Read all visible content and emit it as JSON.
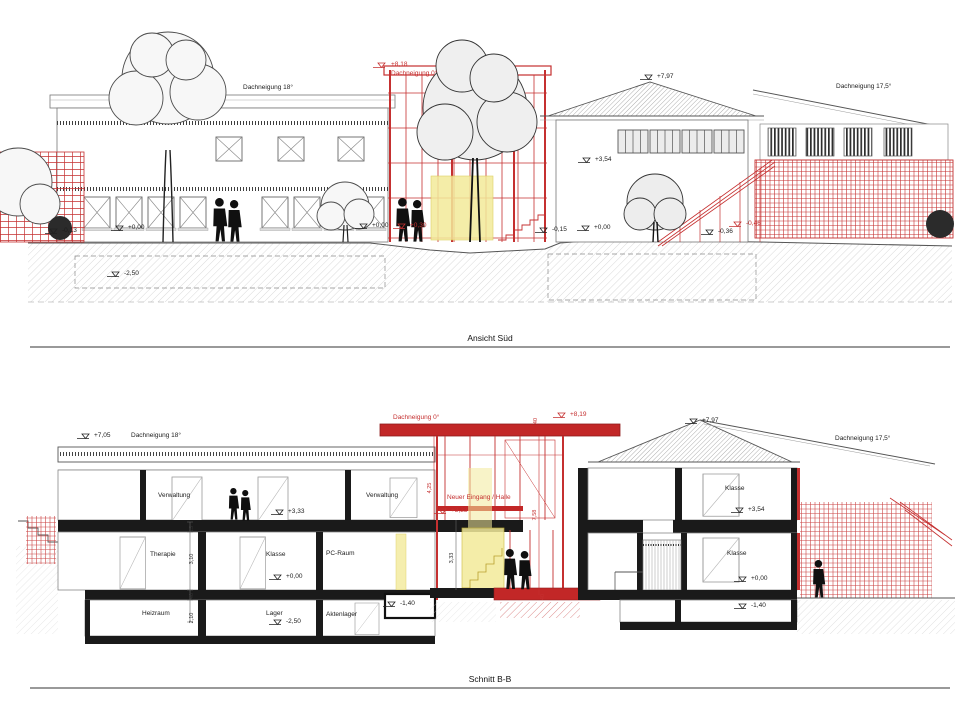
{
  "colors": {
    "red_line": "#c53030",
    "red_fill": "#c22727",
    "black": "#1a1a1a",
    "yellow": "#f3ea9a",
    "hatch_gray": "#cfcfcf"
  },
  "elevation": {
    "caption": "Ansicht Süd",
    "labels": {
      "roof_left": "Dachneigung 18°",
      "red_level": "+8,18",
      "red_roof": "Dachneigung 0°",
      "ridge_level": "+7,97",
      "roof_right": "Dachneigung 17,5°",
      "lvl_m013": "-0,13",
      "lvl_000_a": "+0,00",
      "lvl_000_b": "+0,00",
      "lvl_030_red": "+0,30",
      "lvl_354": "+3,54",
      "lvl_m015": "-0,15",
      "lvl_000_c": "+0,00",
      "lvl_m036": "-0,36",
      "lvl_m046_red": "-0,46",
      "lvl_m250": "-2,50"
    }
  },
  "section": {
    "caption": "Schnitt B-B",
    "labels": {
      "lvl_705": "+7,05",
      "roof_left": "Dachneigung 18°",
      "red_roof": "Dachneigung 0°",
      "red_level": "+8,19",
      "ridge_level": "+7,97",
      "roof_right": "Dachneigung 17,5°",
      "lvl_333": "+3,33",
      "lvl_333_red": "+3,33",
      "lvl_000_l": "+0,00",
      "lvl_m250": "-2,50",
      "lvl_m140_l": "-1,40",
      "lvl_354": "+3,54",
      "lvl_000_r": "+0,00",
      "lvl_m140_r": "-1,40"
    },
    "rooms": {
      "verwaltung_a": "Verwaltung",
      "verwaltung_b": "Verwaltung",
      "eingang": "Neuer Eingang / Halle",
      "therapie": "Therapie",
      "klasse_a": "Klasse",
      "pc_raum": "PC-Raum",
      "heizraum": "Heizraum",
      "lager": "Lager",
      "aktenlager": "Aktenlager",
      "klasse_b": "Klasse",
      "klasse_c": "Klasse"
    },
    "dims": {
      "d15": "15",
      "d310": "3,10",
      "d40_a": "40",
      "d210": "2,10",
      "d425": "4,25",
      "d758": "7,58",
      "d333": "3,33",
      "d40_b": "40",
      "d40_roof": "40"
    }
  }
}
